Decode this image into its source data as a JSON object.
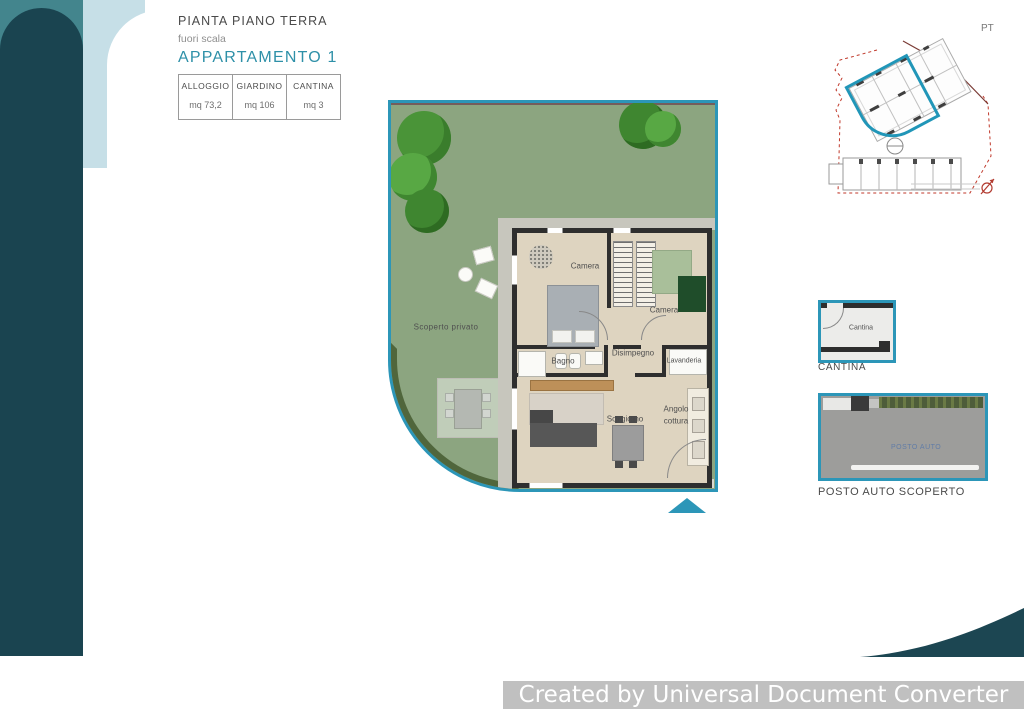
{
  "header": {
    "plan_title": "PIANTA PIANO TERRA",
    "scale_note": "fuori scala",
    "apartment_title": "APPARTAMENTO 1"
  },
  "summary_table": {
    "columns": [
      {
        "label": "ALLOGGIO",
        "value": "mq 73,2"
      },
      {
        "label": "GIARDINO",
        "value": "mq 106"
      },
      {
        "label": "CANTINA",
        "value": "mq 3"
      }
    ]
  },
  "floor_plan": {
    "garden_label": "Scoperto privato",
    "rooms": {
      "camera_1": "Camera",
      "camera_2": "Camera",
      "bagno": "Bagno",
      "disimpegno": "Disimpegno",
      "lavanderia": "Lavanderia",
      "soggiorno": "Soggiorno",
      "angolo_cottura_line1": "Angolo",
      "angolo_cottura_line2": "cottura"
    }
  },
  "site_plan": {
    "floor_tag": "PT"
  },
  "cantina": {
    "room_label": "Cantina",
    "caption": "CANTINA"
  },
  "parking": {
    "stencil_text": "POSTO AUTO",
    "caption": "POSTO AUTO SCOPERTO"
  },
  "watermark": {
    "text": "Created by Universal Document Converter"
  },
  "colors": {
    "accent_teal": "#2c96b8",
    "title_teal": "#2e90a8",
    "brand_dark_teal": "#1a4450",
    "brand_mid_teal": "#43858d",
    "brand_light_blue": "#c6dfe7",
    "garden_green": "#8ca580",
    "wall_dark": "#2e2e2e",
    "boundary_red": "#c0392b"
  }
}
